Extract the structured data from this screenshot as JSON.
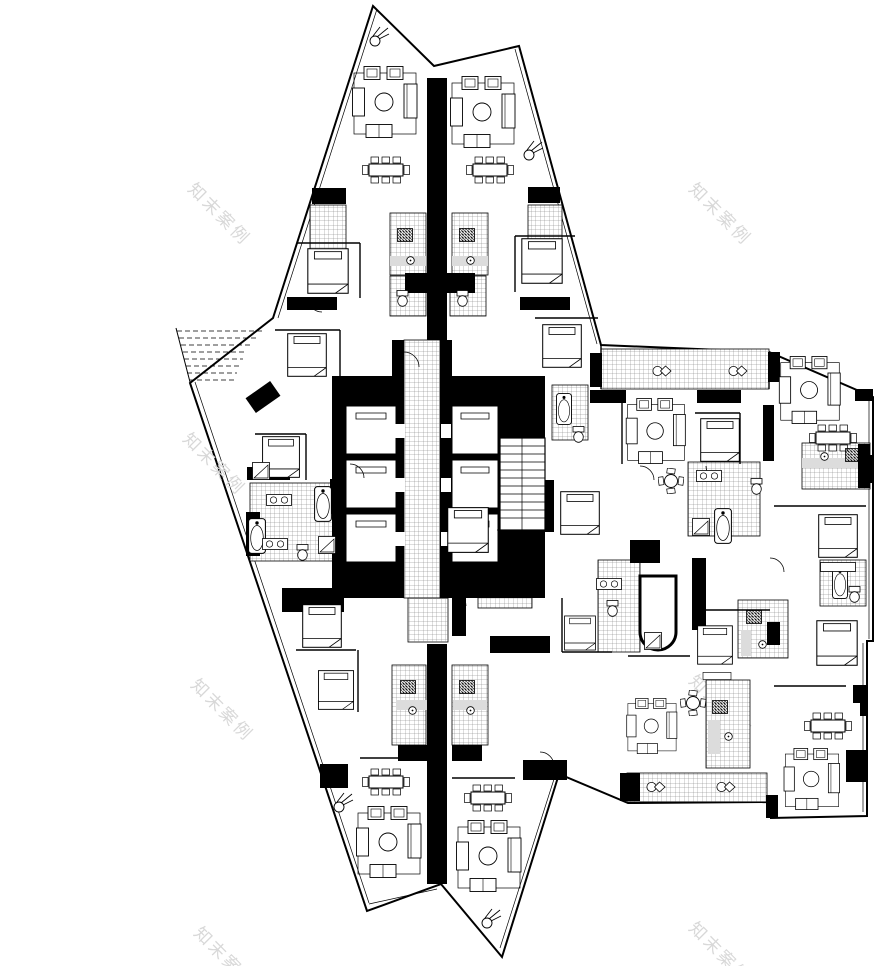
{
  "document": {
    "kind": "architectural floor plan",
    "floor": "residential tower typical floor"
  },
  "watermark": {
    "text": "知末案例",
    "color": "#d8d8d8",
    "instances": 8
  },
  "palette": {
    "paper": "#ffffff",
    "ink": "#000000",
    "tile_line": "#777777",
    "fixture_shade": "#dcdcdc",
    "watermark": "#d8d8d8"
  },
  "plan": {
    "walls": [
      [
        427,
        78,
        20,
        262
      ],
      [
        427,
        644,
        20,
        240
      ],
      [
        332,
        376,
        72,
        18
      ],
      [
        440,
        376,
        105,
        18
      ],
      [
        332,
        392,
        213,
        206
      ],
      [
        392,
        340,
        12,
        38
      ],
      [
        440,
        340,
        12,
        38
      ],
      [
        312,
        188,
        34,
        16
      ],
      [
        528,
        187,
        32,
        16
      ],
      [
        287,
        297,
        50,
        13
      ],
      [
        520,
        297,
        50,
        13
      ],
      [
        405,
        273,
        28,
        20
      ],
      [
        447,
        273,
        28,
        20
      ],
      [
        282,
        588,
        62,
        24
      ],
      [
        246,
        512,
        14,
        44
      ],
      [
        330,
        479,
        13,
        35
      ],
      [
        247,
        467,
        43,
        13
      ],
      [
        630,
        540,
        30,
        23
      ],
      [
        692,
        558,
        14,
        72
      ],
      [
        590,
        390,
        36,
        13
      ],
      [
        697,
        390,
        44,
        13
      ],
      [
        590,
        353,
        12,
        34
      ],
      [
        763,
        405,
        11,
        56
      ],
      [
        768,
        352,
        12,
        30
      ],
      [
        855,
        389,
        18,
        12
      ],
      [
        523,
        760,
        44,
        20
      ],
      [
        320,
        764,
        28,
        24
      ],
      [
        620,
        773,
        20,
        28
      ],
      [
        766,
        795,
        12,
        23
      ],
      [
        846,
        750,
        22,
        32
      ],
      [
        853,
        685,
        15,
        18
      ],
      [
        767,
        622,
        13,
        23
      ],
      [
        490,
        636,
        60,
        17
      ],
      [
        452,
        596,
        14,
        40
      ],
      [
        428,
        565,
        117,
        22
      ],
      [
        398,
        745,
        30,
        16
      ],
      [
        452,
        745,
        30,
        16
      ],
      [
        858,
        444,
        12,
        44
      ],
      [
        866,
        455,
        7,
        28
      ],
      [
        860,
        690,
        7,
        26
      ],
      [
        540,
        480,
        14,
        52
      ],
      [
        248,
        388,
        30,
        18,
        "rotate(-35 263 397)"
      ]
    ],
    "hatches": [
      [
        310,
        205,
        36,
        44
      ],
      [
        528,
        205,
        34,
        42
      ],
      [
        390,
        213,
        36,
        62
      ],
      [
        452,
        213,
        36,
        62
      ],
      [
        390,
        276,
        36,
        40
      ],
      [
        450,
        276,
        36,
        40
      ],
      [
        601,
        349,
        168,
        40
      ],
      [
        627,
        773,
        140,
        29
      ],
      [
        392,
        665,
        34,
        80
      ],
      [
        452,
        665,
        36,
        80
      ],
      [
        250,
        483,
        95,
        78
      ],
      [
        688,
        462,
        72,
        74
      ],
      [
        820,
        560,
        46,
        46
      ],
      [
        598,
        560,
        42,
        92
      ],
      [
        738,
        600,
        50,
        58
      ],
      [
        706,
        680,
        44,
        88
      ],
      [
        802,
        443,
        68,
        46
      ],
      [
        552,
        385,
        36,
        55
      ],
      [
        478,
        596,
        54,
        12
      ]
    ],
    "shades": [
      [
        390,
        256,
        36,
        10
      ],
      [
        452,
        256,
        36,
        10
      ],
      [
        396,
        700,
        34,
        10
      ],
      [
        453,
        700,
        34,
        10
      ],
      [
        802,
        458,
        56,
        10
      ],
      [
        708,
        720,
        12,
        34
      ],
      [
        741,
        630,
        10,
        26
      ]
    ],
    "furniture": [
      [
        "bed",
        303,
        248,
        50,
        46
      ],
      [
        "bed",
        283,
        333,
        48,
        44
      ],
      [
        "bed",
        258,
        436,
        46,
        42
      ],
      [
        "bed",
        299,
        604,
        46,
        44
      ],
      [
        "bed",
        315,
        670,
        42,
        40
      ],
      [
        "bed",
        517,
        238,
        50,
        46
      ],
      [
        "bed",
        538,
        324,
        48,
        44
      ],
      [
        "bed",
        700,
        418,
        40,
        44
      ],
      [
        "bed",
        697,
        624,
        36,
        42
      ],
      [
        "bed",
        815,
        620,
        44,
        46
      ],
      [
        "bed",
        816,
        514,
        44,
        44
      ],
      [
        "bed",
        564,
        614,
        32,
        38
      ],
      [
        "bed",
        447,
        506,
        42,
        48
      ],
      [
        "bed",
        560,
        490,
        40,
        46
      ],
      [
        "sofa",
        352,
        66
      ],
      [
        "sofa",
        450,
        76
      ],
      [
        "sofa",
        356,
        806
      ],
      [
        "sofa",
        456,
        820
      ],
      [
        "sofa",
        625,
        398,
        62,
        66
      ],
      [
        "sofa",
        778,
        356,
        64,
        68
      ],
      [
        "sofa",
        783,
        748,
        58,
        62
      ],
      [
        "sofa",
        626,
        698,
        52,
        56
      ],
      [
        "dining",
        362,
        156
      ],
      [
        "dining",
        466,
        156
      ],
      [
        "dining",
        362,
        768
      ],
      [
        "dining",
        464,
        784
      ],
      [
        "dining",
        803,
        712,
        50,
        28
      ],
      [
        "dining",
        808,
        424,
        50,
        28
      ],
      [
        "rtable",
        658,
        468
      ],
      [
        "rtable",
        680,
        690
      ],
      [
        "tub",
        314,
        486
      ],
      [
        "tub",
        248,
        518
      ],
      [
        "tub",
        714,
        508
      ],
      [
        "tub",
        832,
        566,
        16,
        34
      ],
      [
        "tub",
        556,
        392,
        16,
        34
      ],
      [
        "toilet",
        396,
        290
      ],
      [
        "toilet",
        456,
        290
      ],
      [
        "toilet",
        750,
        478
      ],
      [
        "toilet",
        606,
        600
      ],
      [
        "toilet",
        296,
        544
      ],
      [
        "toilet",
        572,
        426
      ],
      [
        "toilet",
        848,
        586
      ],
      [
        "shower",
        318,
        536
      ],
      [
        "shower",
        692,
        518
      ],
      [
        "shower",
        644,
        632
      ],
      [
        "shower",
        252,
        462
      ],
      [
        "vanity",
        266,
        494
      ],
      [
        "vanity",
        262,
        538
      ],
      [
        "vanity",
        696,
        470
      ],
      [
        "vanity",
        596,
        578
      ],
      [
        "stove",
        397,
        228
      ],
      [
        "stove",
        459,
        228
      ],
      [
        "stove",
        400,
        680
      ],
      [
        "stove",
        459,
        680
      ],
      [
        "stove",
        845,
        448
      ],
      [
        "stove",
        712,
        700
      ],
      [
        "stove",
        746,
        610
      ],
      [
        "sink",
        406,
        256
      ],
      [
        "sink",
        466,
        256
      ],
      [
        "sink",
        408,
        706
      ],
      [
        "sink",
        466,
        706
      ],
      [
        "sink",
        820,
        452
      ],
      [
        "sink",
        724,
        732
      ],
      [
        "sink",
        758,
        640
      ],
      [
        "basinpair",
        652,
        364
      ],
      [
        "basinpair",
        728,
        364
      ],
      [
        "basinpair",
        646,
        780
      ],
      [
        "basinpair",
        716,
        780
      ],
      [
        "plant",
        368,
        26
      ],
      [
        "plant",
        522,
        140
      ],
      [
        "plant",
        332,
        792
      ],
      [
        "plant",
        480,
        908
      ],
      [
        "table",
        820,
        562,
        36,
        10
      ],
      [
        "table",
        700,
        672,
        34,
        8
      ]
    ]
  }
}
